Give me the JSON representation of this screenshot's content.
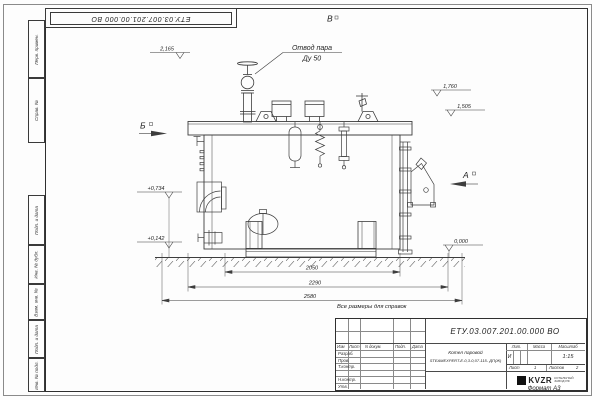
{
  "page": {
    "top_stamp": "ЕТУ.03.007.201.00.000 ВО",
    "note": "Все размеры для справок",
    "format_label": "Формат А3"
  },
  "margin_stamps": {
    "perv_primen": "Перв. примен.",
    "sprav_no": "Справ. №",
    "podp_data_1": "Подп. и дата",
    "inv_dubl": "Инв. № дубл.",
    "vzam_inv": "Взам. инв. №",
    "podp_data_2": "Подп. и дата",
    "inv_podl": "Инв. № подл."
  },
  "drawing": {
    "callout_line1": "Отвод пара",
    "callout_line2": "Ду 50",
    "view_v": "В",
    "view_b": "Б",
    "view_a": "А",
    "elev_top": "2,165",
    "elev_right_upper": "1,760",
    "elev_right_mid": "1,505",
    "elev_left_upper": "+0,734",
    "elev_left_lower": "+0,142",
    "elev_zero": "0,000",
    "dim_base": "2050",
    "dim_mid": "2290",
    "dim_overall": "2580"
  },
  "title_block": {
    "doc_number": "ЕТУ.03.007.201.00.000 ВО",
    "product_line1": "Котел паровой",
    "product_line2": "STEAMEXPERT-E-0,3-0,07-115- ДП(Ж)",
    "col_izm": "Изм",
    "col_list": "Лист",
    "col_ndoc": "N докум.",
    "col_podp": "Подп.",
    "col_data": "Дата",
    "row_razrab": "Разраб.",
    "row_prov": "Пров.",
    "row_tkontr": "Т.контр.",
    "row_nkontr": "Н.контр.",
    "row_utv": "Утв.",
    "lit_label": "Лит.",
    "massa_label": "Масса",
    "masshtab_label": "Масштаб",
    "lit_value": "И",
    "scale_value": "1:15",
    "list_label": "Лист",
    "list_value": "1",
    "listov_label": "Листов",
    "listov_value": "2",
    "logo_text": "KVZR",
    "logo_sub1": "КОТЕЛЬНЫЙ",
    "logo_sub2": "ЗАВОД РФ"
  },
  "colors": {
    "line": "#3d3d3d",
    "paper": "#ffffff"
  }
}
